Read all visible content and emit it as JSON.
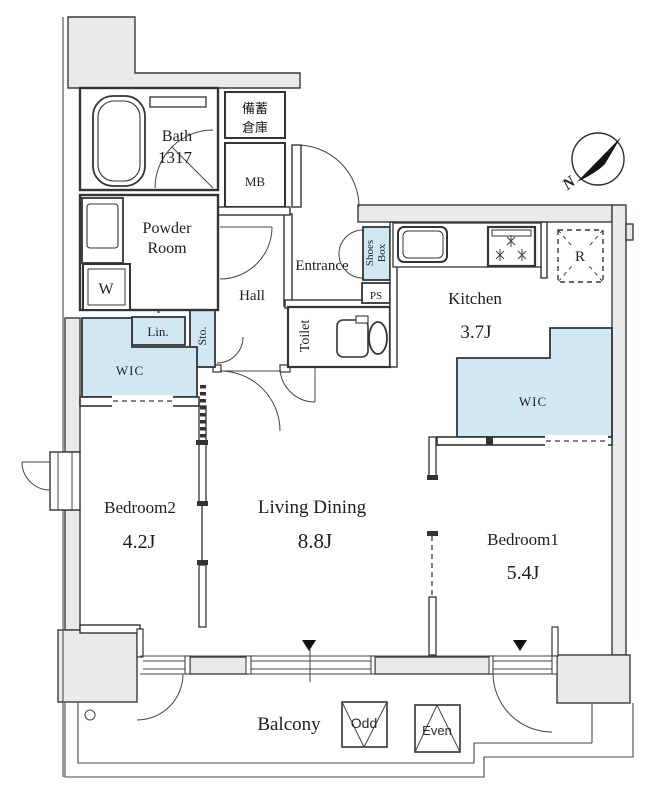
{
  "plan": {
    "colors": {
      "wall_fill": "#e9eaec",
      "closet_fill": "#cfe8f4",
      "line": "#383838"
    },
    "rooms": {
      "bath": {
        "label": "Bath",
        "size": "1317"
      },
      "powder_room": {
        "line1": "Powder",
        "line2": "Room"
      },
      "storage_closet": {
        "line1": "備蓄",
        "line2": "倉庫"
      },
      "entrance": {
        "label": "Entrance"
      },
      "hall": {
        "label": "Hall"
      },
      "toilet": {
        "label": "Toilet"
      },
      "shoes_box": {
        "line1": "Shoes",
        "line2": "Box"
      },
      "sto": {
        "label": "Sto."
      },
      "lin": {
        "label": "Lin."
      },
      "wic_left": {
        "label": "WIC"
      },
      "wic_right": {
        "label": "WIC"
      },
      "kitchen": {
        "label": "Kitchen",
        "area": "3.7J"
      },
      "living_dining": {
        "label": "Living Dining",
        "area": "8.8J"
      },
      "bedroom1": {
        "label": "Bedroom1",
        "area": "5.4J"
      },
      "bedroom2": {
        "label": "Bedroom2",
        "area": "4.2J"
      },
      "balcony": {
        "label": "Balcony"
      }
    },
    "fixtures": {
      "meter_box": "MB",
      "ps_left": "PS",
      "ps_right": "PS",
      "washer": "W",
      "refrigerator": "R"
    },
    "markers": {
      "odd": "Odd",
      "even": "Even",
      "north": "N"
    }
  }
}
